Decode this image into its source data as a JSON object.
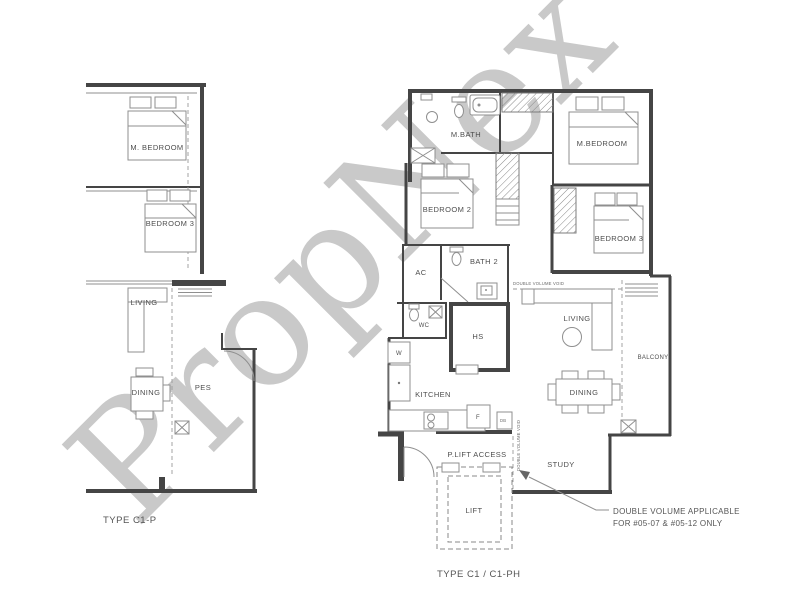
{
  "watermark": "PropNex",
  "left_plan": {
    "title": "TYPE C1-P",
    "rooms": {
      "m_bedroom": "M. BEDROOM",
      "bedroom_3": "BEDROOM 3",
      "living": "LIVING",
      "dining": "DINING",
      "pes": "PES"
    }
  },
  "right_plan": {
    "title": "TYPE C1 / C1-PH",
    "rooms": {
      "m_bath": "M.BATH",
      "m_bedroom": "M.BEDROOM",
      "bedroom_2": "BEDROOM 2",
      "bedroom_3": "BEDROOM 3",
      "bath_2": "BATH 2",
      "ac": "AC",
      "wc": "WC",
      "hs": "HS",
      "kitchen": "KITCHEN",
      "living": "LIVING",
      "dining": "DINING",
      "balcony": "BALCONY",
      "study": "STUDY",
      "lift": "LIFT",
      "private_lift_access": "P.LIFT ACCESS"
    },
    "appliances": {
      "washer": "W",
      "fridge": "F",
      "db": "DB"
    },
    "notes": {
      "double_volume_line1": "DOUBLE VOLUME APPLICABLE",
      "double_volume_line2": "FOR #05-07 & #05-12 ONLY",
      "void_label": "DOUBLE VOLUME VOID"
    }
  },
  "colors": {
    "background": "#ffffff",
    "wall": "#454545",
    "furniture": "#8f8f8f",
    "label": "#4e4e4e",
    "watermark": "#bcbcbc"
  }
}
